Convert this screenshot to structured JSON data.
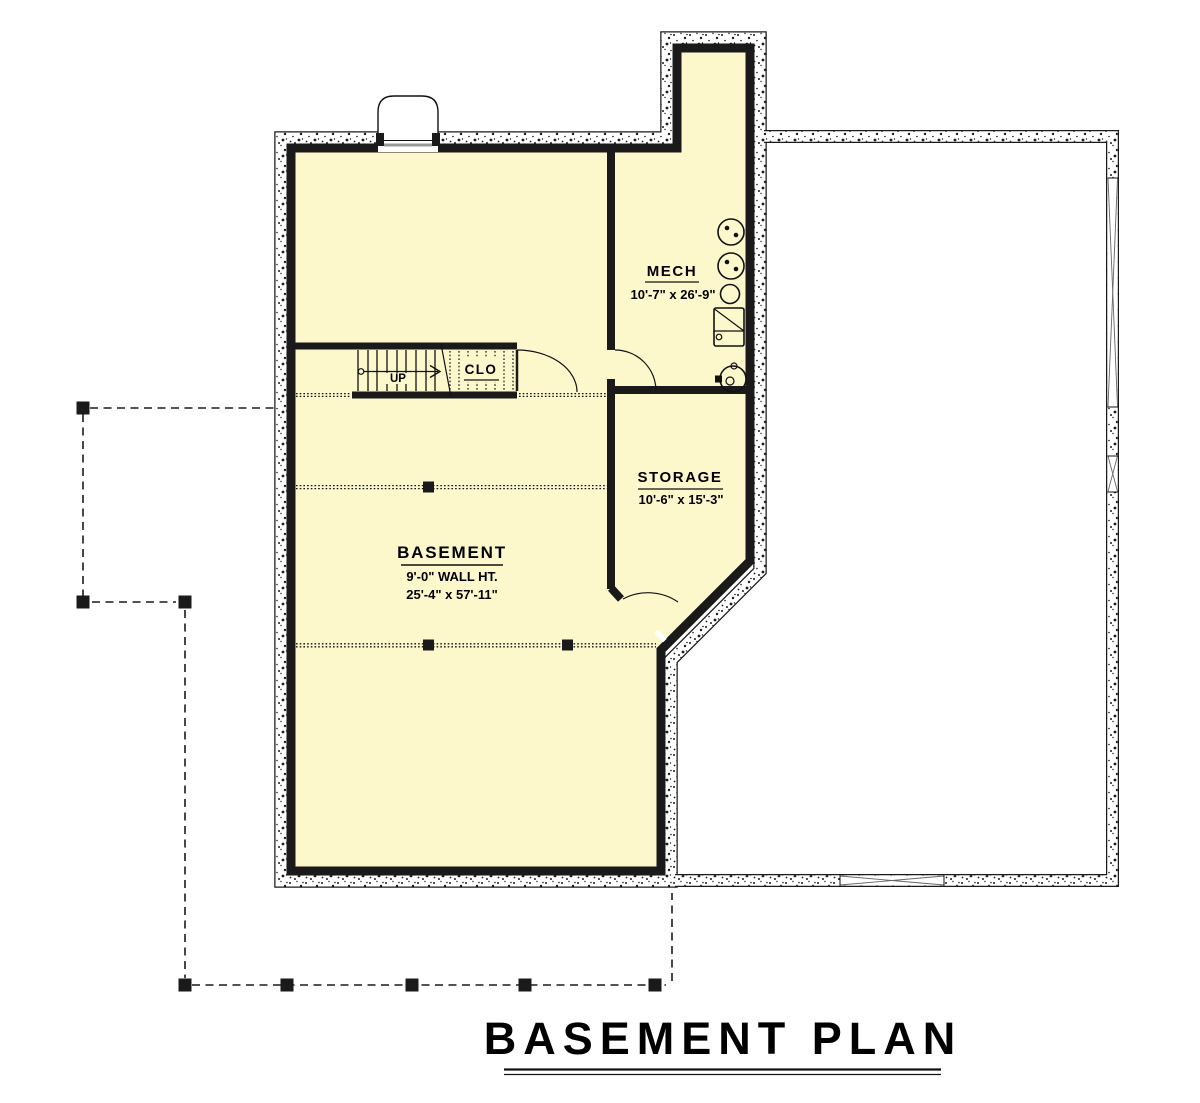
{
  "title": {
    "text": "BASEMENT PLAN"
  },
  "rooms": {
    "mech": {
      "name": "MECH",
      "dims": "10'-7\" x 26'-9\""
    },
    "storage": {
      "name": "STORAGE",
      "dims": "10'-6\" x 15'-3\""
    },
    "basement": {
      "name": "BASEMENT",
      "wall_height": "9'-0\" WALL HT.",
      "dims": "25'-4\" x 57'-11\""
    },
    "closet": {
      "name": "CLO"
    }
  },
  "stairs": {
    "direction_label": "UP"
  },
  "colors": {
    "room_fill": "#FCF8CC",
    "wall": "#1a1a1a",
    "background": "#ffffff",
    "line": "#111111"
  }
}
